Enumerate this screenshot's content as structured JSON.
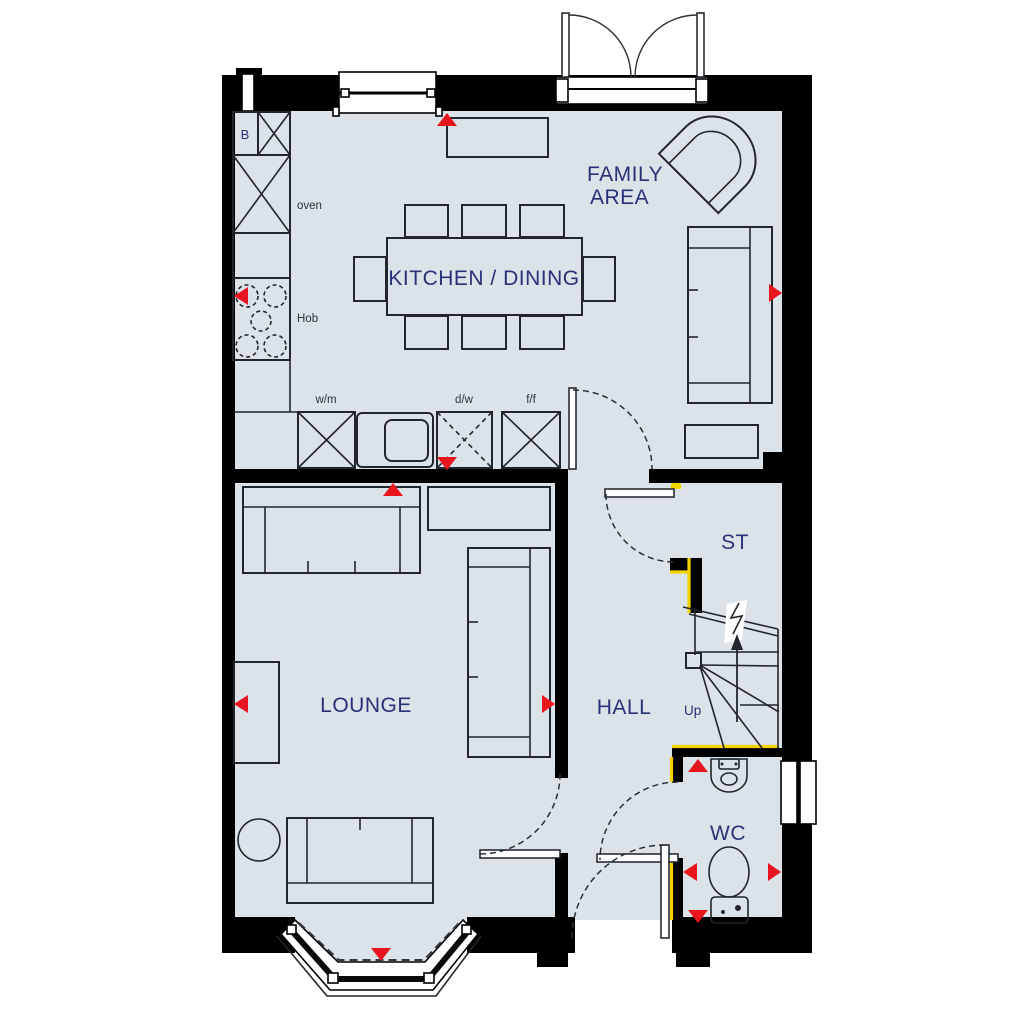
{
  "title": "Ground floor plan",
  "colors": {
    "floor": "#dbe2e8",
    "wall": "#000000",
    "dimension_arrow": "#e8141e",
    "protected_wall": "#f2d400",
    "room_label": "#293179",
    "small_label": "#2b3340",
    "window": "#ffffff"
  },
  "labels": {
    "kitchen_dining": "KITCHEN / DINING",
    "family_line1": "FAMILY",
    "family_line2": "AREA",
    "lounge": "LOUNGE",
    "hall": "HALL",
    "store": "ST",
    "wc": "WC",
    "stairs_up": "Up",
    "boiler": "B",
    "oven": "oven",
    "hob": "Hob",
    "washing_machine": "w/m",
    "dishwasher": "d/w",
    "fridge_freezer": "f/f"
  },
  "fixtures": [
    "boiler-cupboard",
    "tall-unit",
    "oven-housing",
    "hob",
    "worktop",
    "sink-unit",
    "washing-machine",
    "dishwasher",
    "fridge-freezer",
    "dining-table-with-8-chairs",
    "armchair",
    "family-sofa",
    "side-table",
    "lounge-sofa",
    "sideboard",
    "tv-unit",
    "round-table",
    "staircase-up",
    "store-cupboard",
    "wc-basin",
    "wc-toilet",
    "bay-window",
    "french-doors",
    "front-door",
    "kitchen-window",
    "wc-window",
    "flue"
  ]
}
